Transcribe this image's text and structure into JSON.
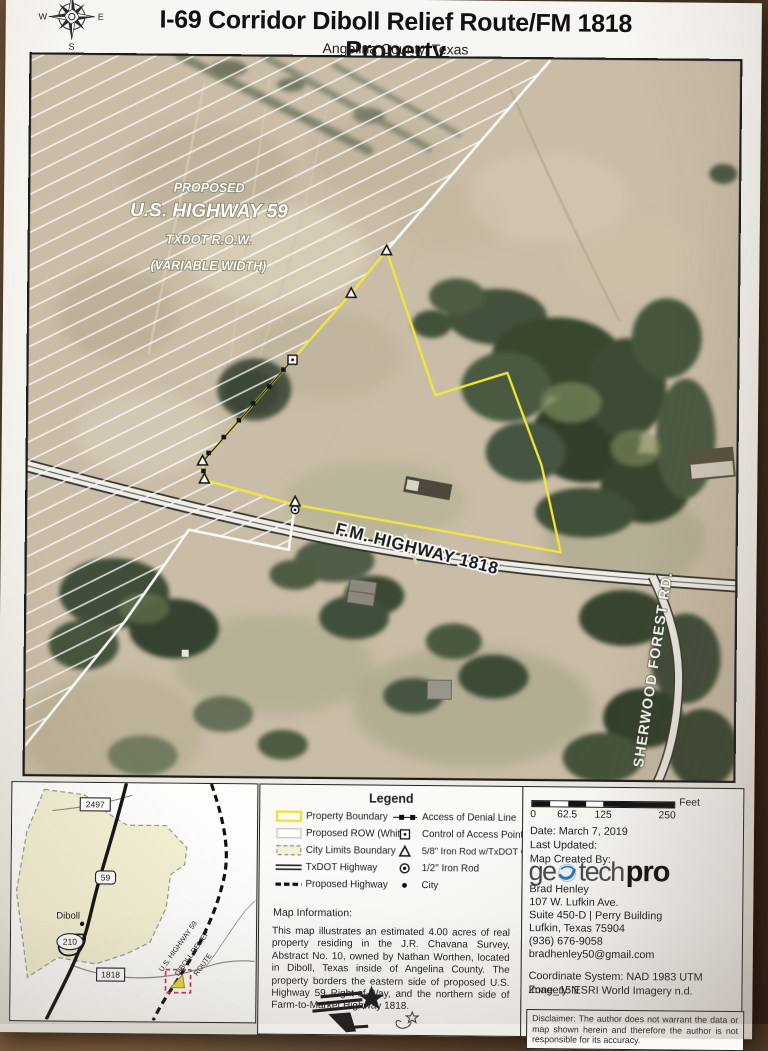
{
  "header": {
    "title": "I-69 Corridor Diboll Relief Route/FM 1818 Property",
    "subtitle": "Angelina County, Texas",
    "compass": {
      "n": "N",
      "e": "E",
      "s": "S",
      "w": "W"
    }
  },
  "map": {
    "labels": {
      "row_line1": "PROPOSED",
      "row_line2": "U.S. HIGHWAY 59",
      "row_line3": "TXDOT R.O.W.",
      "row_line4": "(VARIABLE WIDTH)",
      "fm_highway": "F.M. HIGHWAY 1818",
      "sherwood_road": "SHERWOOD  FOREST  RD."
    }
  },
  "inset": {
    "shield_2497": "2497",
    "shield_59": "59",
    "shield_210": "210",
    "shield_1818": "1818",
    "city_label": "Diboll",
    "route_label_line1": "U.S. HIGHWAY 59",
    "route_label_line2": "DIBOLL RELIEF",
    "route_label_line3": "ROUTE"
  },
  "legend": {
    "title": "Legend",
    "items_left": [
      {
        "symbol": "property-boundary-swatch",
        "label": "Property Boundary"
      },
      {
        "symbol": "proposed-row-swatch",
        "label": "Proposed ROW (White)"
      },
      {
        "symbol": "city-limits-swatch",
        "label": "City Limits Boundary"
      },
      {
        "symbol": "txdot-highway-swatch",
        "label": "TxDOT Highway"
      },
      {
        "symbol": "proposed-highway-swatch",
        "label": "Proposed Highway"
      }
    ],
    "items_right": [
      {
        "symbol": "access-denial-line-symbol",
        "label": "Access of Denial Line"
      },
      {
        "symbol": "control-access-point-symbol",
        "label": "Control of Access Point"
      },
      {
        "symbol": "iron-rod-txdot-cap-symbol",
        "label": "5/8\" Iron Rod w/TxDOT Cap"
      },
      {
        "symbol": "iron-rod-half-symbol",
        "label": "1/2\" Iron Rod"
      },
      {
        "symbol": "city-dot-symbol",
        "label": "City"
      }
    ]
  },
  "map_information": {
    "heading": "Map Information:",
    "body": "This map illustrates an estimated 4.00 acres of real property residing in the J.R. Chavana Survey, Abstract No. 10, owned by Nathan Worthen, located in Diboll, Texas inside of Angelina County. The property borders the eastern side of proposed U.S. Highway 59 Right-of-Way, and the northern side of Farm-to-Market Highway 1818."
  },
  "scale_bar": {
    "ticks": [
      "0",
      "62.5",
      "125",
      "250"
    ],
    "unit": "Feet"
  },
  "credits": {
    "date": "Date: March 7, 2019",
    "last_updated": "Last Updated:",
    "created_by": "Map Created By:",
    "logo_part1": "ge",
    "logo_part2": "tech",
    "logo_part3": "pro",
    "author": "Brad Henley",
    "address_line1": "107 W. Lufkin Ave.",
    "address_line2": "Suite 450-D | Perry Building",
    "address_line3": "Lufkin, Texas 75904",
    "phone": "(936) 676-9058",
    "email": "bradhenley50@gmail.com",
    "coordinate_system": "Coordinate System: NAD 1983 UTM Zone_15N",
    "imagery": "Imagery: ESRI World Imagery n.d."
  },
  "disclaimer": "Disclaimer: The author does not warrant the data or map shown herein and therefore the author is not responsible for its accuracy.",
  "colors": {
    "property_boundary_yellow": "#f1e73b",
    "city_limits_fill": "#f3f0d3",
    "proposed_row_white": "#fbfaf6",
    "geotech_blue": "#2877b8",
    "table_background_brown": "#5f4430"
  }
}
